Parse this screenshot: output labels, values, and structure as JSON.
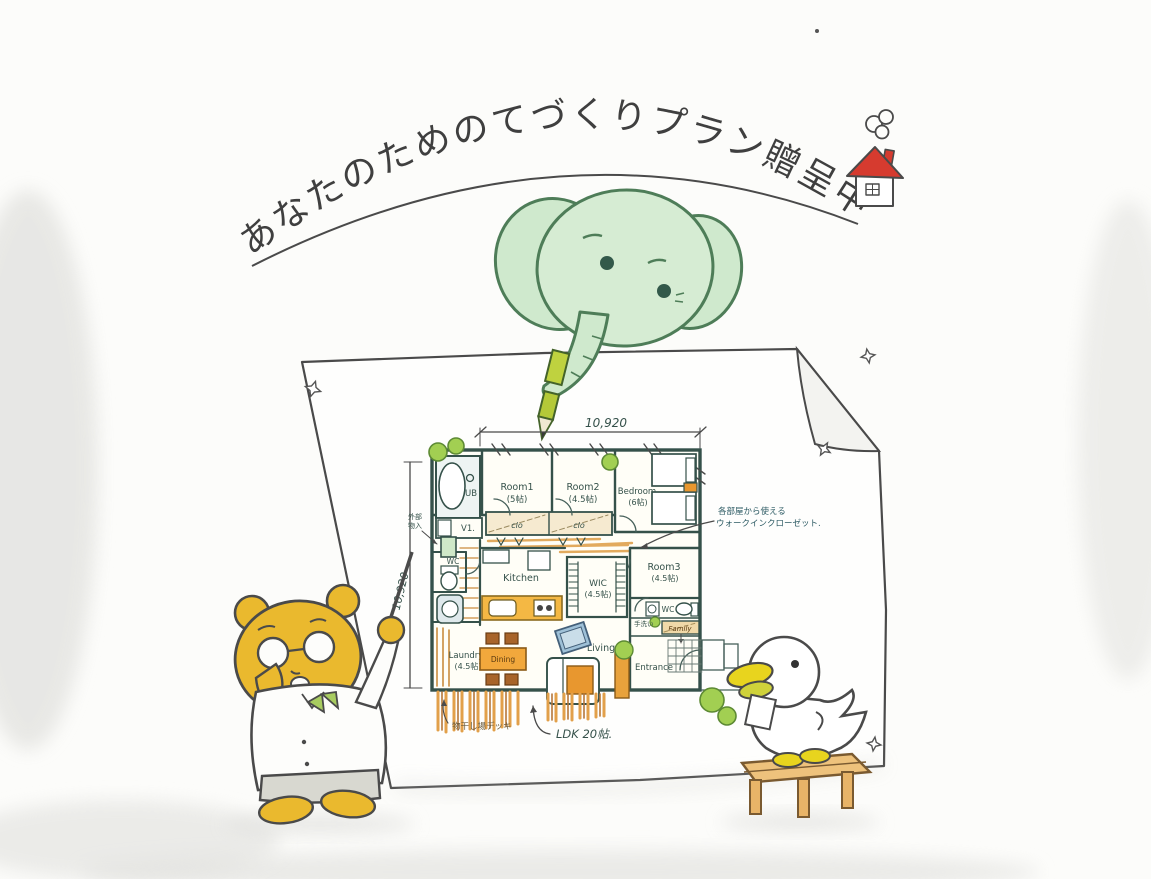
{
  "illustration": {
    "arc_title": "あなたのためのてづくりプラン贈呈中"
  },
  "palette": {
    "ink": "#3f3f3f",
    "plan_wall": "#35514a",
    "wood_orange": "#e8a23c",
    "roof_red": "#d63b2f",
    "elephant_green": "#d2ebd0",
    "bear_yellow": "#eab92e",
    "bush_green": "#a2cf52",
    "counter_orange": "#f4b844"
  },
  "plan": {
    "dim_top": "10,920",
    "dim_left": "10,920",
    "rooms": {
      "room1": {
        "name": "Room1",
        "size": "(5帖)"
      },
      "room2": {
        "name": "Room2",
        "size": "(4.5帖)"
      },
      "bedroom": {
        "name": "Bedroom",
        "size": "(6帖)"
      },
      "room3": {
        "name": "Room3",
        "size": "(4.5帖)"
      },
      "wic": {
        "name": "WIC",
        "size": "(4.5帖)"
      },
      "laundry": {
        "name": "Laundry",
        "size": "(4.5帖)"
      },
      "kitchen": {
        "name": "Kitchen"
      },
      "dining": {
        "name": "Dining"
      },
      "living": {
        "name": "Living"
      },
      "entrance": {
        "name": "Entrance"
      },
      "ub": {
        "name": "UB"
      },
      "vanity": {
        "name": "V1."
      },
      "wc_left": {
        "name": "WC"
      },
      "wc_right": {
        "name": "WC"
      },
      "closet1": {
        "name": "clo"
      },
      "closet2": {
        "name": "clo"
      },
      "family": {
        "name": "Family"
      }
    },
    "notes": {
      "wic_line1": "各部屋から使える",
      "wic_line2": "ウォークインクローゼット.",
      "ldk": "LDK 20帖.",
      "deck": "物干し場デッキ",
      "storage_l1": "外部",
      "storage_l2": "物入",
      "handwash": "手洗い"
    }
  }
}
